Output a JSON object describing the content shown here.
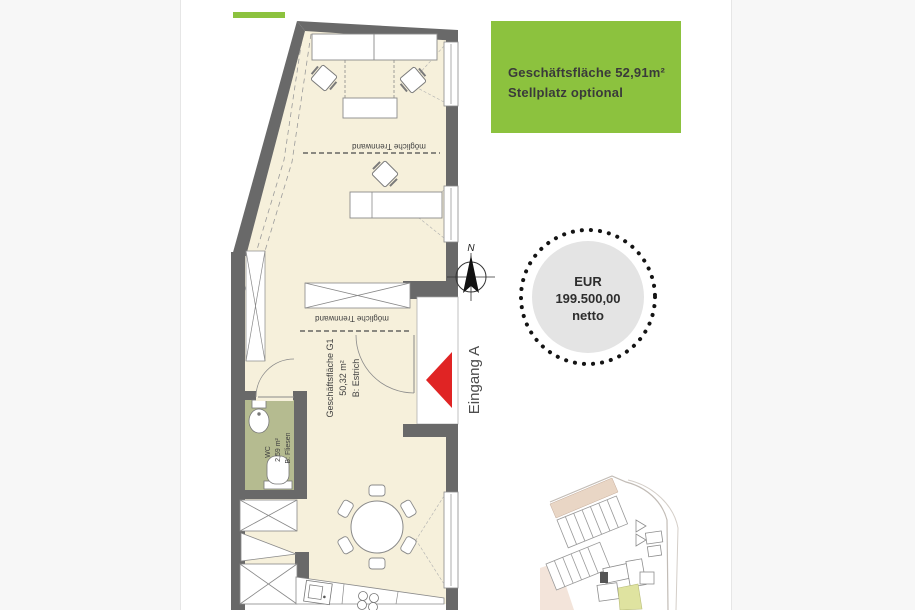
{
  "colors": {
    "page_bg": "#f7f7f7",
    "panel_bg": "#ffffff",
    "accent_green": "#8cc23e",
    "arrow_red": "#e02424",
    "wall_gray": "#696969",
    "floor_cream": "#f6f0db",
    "wc_floor_green": "#b5bb90",
    "badge_gray": "#e4e4e4"
  },
  "info_box": {
    "line1": "Geschäftsfläche 52,91m²",
    "line2": "Stellplatz optional"
  },
  "price_badge": {
    "currency": "EUR",
    "amount": "199.500,00",
    "suffix": "netto"
  },
  "floor_plan": {
    "compass_n": "N",
    "entrance_label": "Eingang A",
    "partition_label_1": "mögliche Trennwand",
    "partition_label_2": "mögliche Trennwand",
    "room": {
      "name": "Geschäftsfläche G1",
      "area": "50,32 m²",
      "floor": "B: Estrich"
    },
    "wc": {
      "name": "WC",
      "area": "2,59 m²",
      "floor": "B: Fliesen"
    }
  }
}
